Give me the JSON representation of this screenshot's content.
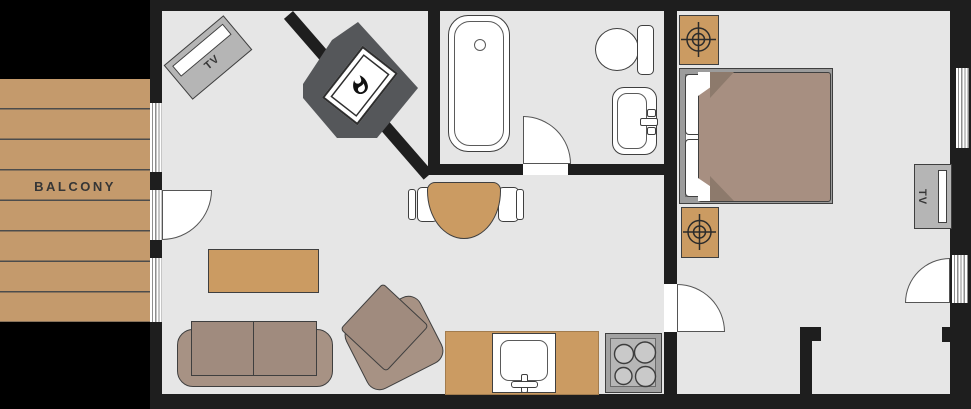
{
  "labels": {
    "balcony": "BALCONY",
    "living_tv": "TV",
    "bedroom_tv": "TV"
  },
  "colors": {
    "background": "#000000",
    "wall": "#1e1e1e",
    "floor": "#e6e6e6",
    "wood": "#c49a6c",
    "wood_line": "#4c4c4c",
    "tan": "#cb9b62",
    "taupe": "#a79284",
    "taupe_dark": "#a08b7e",
    "blanket": "#a78f81",
    "blanket_fold": "#8d7a6c",
    "gray_item": "#b5b5b5",
    "bed_frame": "#9c9c9c",
    "stove": "#a2a2a2",
    "stove_inner": "#b6b6b6",
    "burner": "#c9c9c9",
    "fireplace": "#55575a",
    "outline": "#3f3f3f",
    "door_stroke": "#555555",
    "window_line": "#8e8e8e",
    "text": "#363636",
    "white": "#ffffff"
  }
}
